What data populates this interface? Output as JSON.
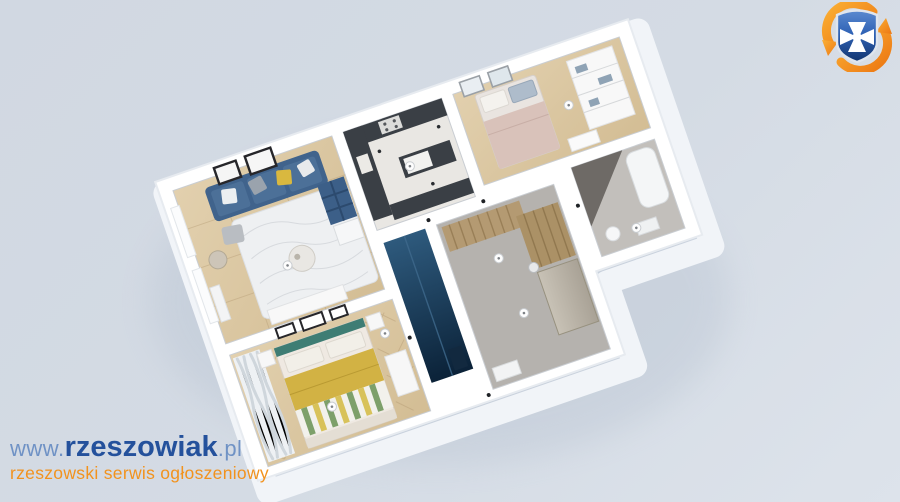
{
  "watermark": {
    "url_prefix": "www.",
    "brand": "rzeszowiak",
    "url_suffix": ".pl",
    "tagline": "rzeszowski serwis ogłoszeniowy"
  },
  "colors": {
    "brand_blue_dark": "#24519c",
    "brand_blue_light": "#6f92c5",
    "brand_orange": "#f2921d",
    "logo_arrow_orange": "#f7941d",
    "background_blue_gray": "#d3dae3",
    "wall_white": "#ffffff",
    "wood_floor": "#dbc8a6",
    "herringbone_floor": "#d5bf99",
    "rug_white": "#eef0f2",
    "sofa_blue": "#40638c",
    "kitchen_counter_dark": "#3a3f45",
    "shower_glass_blue": "#1d3c59",
    "wardrobe_wood": "#b49a72",
    "bed_blanket_yellow": "#d2b244",
    "bed_headboard_teal": "#3e7d74",
    "bed_blanket_pink": "#d9c2ba"
  },
  "floorplan": {
    "description": "3D isometric render of an apartment floor plan",
    "rooms": [
      "living-room",
      "kitchen",
      "small-bedroom",
      "bathroom",
      "hallway-wardrobe",
      "shower-room",
      "main-bedroom"
    ]
  }
}
